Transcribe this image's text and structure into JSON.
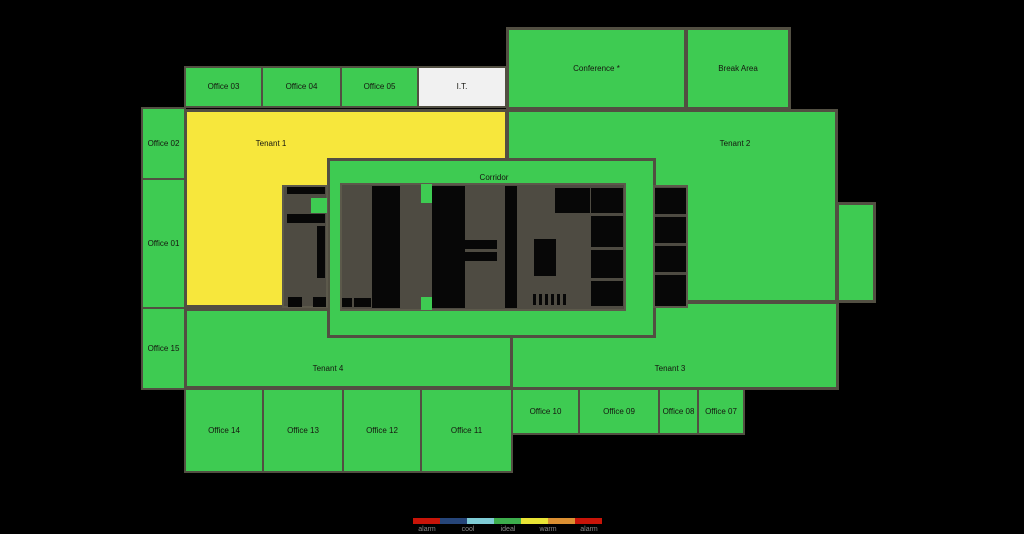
{
  "colors": {
    "background": "#000000",
    "ideal": "#3ecb52",
    "warm": "#f7e73c",
    "neutral": "#f1f1f1",
    "core_base": "#4e4b42",
    "core_black": "#070707",
    "room_border": "#524f42",
    "label_text": "#15150f",
    "legend_label_text": "#8a8a8a"
  },
  "floorplan": {
    "rooms": [
      {
        "id": "tenant-2",
        "label": "Tenant 2",
        "x": 506,
        "y": 109,
        "w": 332,
        "h": 194,
        "fill": "ideal",
        "bw": 3,
        "lab": [
          226,
          32
        ]
      },
      {
        "id": "tenant-2-east-wing",
        "label": "",
        "x": 836,
        "y": 202,
        "w": 40,
        "h": 101,
        "fill": "ideal",
        "bw": 3
      },
      {
        "id": "tenant-1",
        "label": "Tenant 1",
        "x": 184,
        "y": 109,
        "w": 324,
        "h": 199,
        "fill": "warm",
        "bw": 3,
        "lab": [
          84,
          32
        ]
      },
      {
        "id": "tenant-4",
        "label": "Tenant 4",
        "x": 184,
        "y": 308,
        "w": 329,
        "h": 81,
        "fill": "ideal",
        "bw": 3,
        "lab": [
          141,
          58
        ]
      },
      {
        "id": "tenant-3",
        "label": "Tenant 3",
        "x": 510,
        "y": 301,
        "w": 329,
        "h": 89,
        "fill": "ideal",
        "bw": 3,
        "lab": [
          157,
          65
        ]
      },
      {
        "id": "corridor",
        "label": "Corridor",
        "x": 327,
        "y": 158,
        "w": 329,
        "h": 180,
        "fill": "ideal",
        "bw": 3,
        "lab": [
          164,
          17
        ]
      },
      {
        "id": "office-03",
        "label": "Office 03",
        "x": 184,
        "y": 66,
        "w": 79,
        "h": 42,
        "fill": "ideal",
        "bw": 2
      },
      {
        "id": "office-04",
        "label": "Office 04",
        "x": 261,
        "y": 66,
        "w": 81,
        "h": 42,
        "fill": "ideal",
        "bw": 2
      },
      {
        "id": "office-05",
        "label": "Office 05",
        "x": 340,
        "y": 66,
        "w": 79,
        "h": 42,
        "fill": "ideal",
        "bw": 2
      },
      {
        "id": "it-room",
        "label": "I.T.",
        "x": 417,
        "y": 66,
        "w": 90,
        "h": 42,
        "fill": "neutral",
        "bw": 2
      },
      {
        "id": "conference",
        "label": "Conference *",
        "x": 506,
        "y": 27,
        "w": 181,
        "h": 83,
        "fill": "ideal",
        "bw": 3
      },
      {
        "id": "break-area",
        "label": "Break Area",
        "x": 685,
        "y": 27,
        "w": 106,
        "h": 83,
        "fill": "ideal",
        "bw": 3
      },
      {
        "id": "office-02",
        "label": "Office 02",
        "x": 141,
        "y": 107,
        "w": 45,
        "h": 73,
        "fill": "ideal",
        "bw": 2
      },
      {
        "id": "office-01",
        "label": "Office 01",
        "x": 141,
        "y": 178,
        "w": 45,
        "h": 131,
        "fill": "ideal",
        "bw": 2
      },
      {
        "id": "office-15",
        "label": "Office 15",
        "x": 141,
        "y": 307,
        "w": 45,
        "h": 83,
        "fill": "ideal",
        "bw": 2
      },
      {
        "id": "office-14",
        "label": "Office 14",
        "x": 184,
        "y": 388,
        "w": 80,
        "h": 85,
        "fill": "ideal",
        "bw": 2
      },
      {
        "id": "office-13",
        "label": "Office 13",
        "x": 262,
        "y": 388,
        "w": 82,
        "h": 85,
        "fill": "ideal",
        "bw": 2
      },
      {
        "id": "office-12",
        "label": "Office 12",
        "x": 342,
        "y": 388,
        "w": 80,
        "h": 85,
        "fill": "ideal",
        "bw": 2
      },
      {
        "id": "office-11",
        "label": "Office 11",
        "x": 420,
        "y": 388,
        "w": 93,
        "h": 85,
        "fill": "ideal",
        "bw": 2
      },
      {
        "id": "office-10",
        "label": "Office 10",
        "x": 511,
        "y": 388,
        "w": 69,
        "h": 47,
        "fill": "ideal",
        "bw": 2
      },
      {
        "id": "office-09",
        "label": "Office 09",
        "x": 578,
        "y": 388,
        "w": 82,
        "h": 47,
        "fill": "ideal",
        "bw": 2
      },
      {
        "id": "office-08",
        "label": "Office 08",
        "x": 658,
        "y": 388,
        "w": 41,
        "h": 47,
        "fill": "ideal",
        "bw": 2
      },
      {
        "id": "office-07",
        "label": "Office 07",
        "x": 697,
        "y": 388,
        "w": 48,
        "h": 47,
        "fill": "ideal",
        "bw": 2
      }
    ],
    "core": {
      "blocks": [
        {
          "x": 282,
          "y": 185,
          "w": 46,
          "h": 123
        },
        {
          "x": 653,
          "y": 185,
          "w": 35,
          "h": 123
        },
        {
          "x": 340,
          "y": 183,
          "w": 286,
          "h": 128
        }
      ],
      "cells": [
        {
          "x": 287,
          "y": 187,
          "w": 38,
          "h": 7,
          "f": "core_black"
        },
        {
          "x": 311,
          "y": 198,
          "w": 16,
          "h": 15,
          "f": "ideal"
        },
        {
          "x": 287,
          "y": 214,
          "w": 38,
          "h": 9,
          "f": "core_black"
        },
        {
          "x": 317,
          "y": 226,
          "w": 8,
          "h": 52,
          "f": "core_black"
        },
        {
          "x": 288,
          "y": 297,
          "w": 14,
          "h": 10,
          "f": "core_black"
        },
        {
          "x": 313,
          "y": 297,
          "w": 13,
          "h": 10,
          "f": "core_black"
        },
        {
          "x": 372,
          "y": 186,
          "w": 28,
          "h": 122,
          "f": "core_black"
        },
        {
          "x": 342,
          "y": 298,
          "w": 10,
          "h": 9,
          "f": "core_black"
        },
        {
          "x": 354,
          "y": 298,
          "w": 17,
          "h": 9,
          "f": "core_black"
        },
        {
          "x": 432,
          "y": 186,
          "w": 33,
          "h": 122,
          "f": "core_black"
        },
        {
          "x": 465,
          "y": 240,
          "w": 32,
          "h": 9,
          "f": "core_black"
        },
        {
          "x": 465,
          "y": 252,
          "w": 32,
          "h": 9,
          "f": "core_black"
        },
        {
          "x": 505,
          "y": 186,
          "w": 12,
          "h": 122,
          "f": "core_black"
        },
        {
          "x": 534,
          "y": 239,
          "w": 22,
          "h": 37,
          "f": "core_black"
        },
        {
          "x": 555,
          "y": 188,
          "w": 35,
          "h": 25,
          "f": "core_black"
        },
        {
          "x": 591,
          "y": 188,
          "w": 32,
          "h": 25,
          "f": "core_black"
        },
        {
          "x": 591,
          "y": 216,
          "w": 32,
          "h": 31,
          "f": "core_black"
        },
        {
          "x": 591,
          "y": 250,
          "w": 32,
          "h": 28,
          "f": "core_black"
        },
        {
          "x": 591,
          "y": 281,
          "w": 32,
          "h": 25,
          "f": "core_black"
        },
        {
          "x": 533,
          "y": 294,
          "w": 3,
          "h": 11,
          "f": "core_black"
        },
        {
          "x": 539,
          "y": 294,
          "w": 3,
          "h": 11,
          "f": "core_black"
        },
        {
          "x": 545,
          "y": 294,
          "w": 3,
          "h": 11,
          "f": "core_black"
        },
        {
          "x": 551,
          "y": 294,
          "w": 3,
          "h": 11,
          "f": "core_black"
        },
        {
          "x": 557,
          "y": 294,
          "w": 3,
          "h": 11,
          "f": "core_black"
        },
        {
          "x": 563,
          "y": 294,
          "w": 3,
          "h": 11,
          "f": "core_black"
        },
        {
          "x": 655,
          "y": 188,
          "w": 31,
          "h": 26,
          "f": "core_black"
        },
        {
          "x": 655,
          "y": 217,
          "w": 31,
          "h": 26,
          "f": "core_black"
        },
        {
          "x": 655,
          "y": 246,
          "w": 31,
          "h": 26,
          "f": "core_black"
        },
        {
          "x": 655,
          "y": 275,
          "w": 31,
          "h": 31,
          "f": "core_black"
        },
        {
          "x": 421,
          "y": 184,
          "w": 11,
          "h": 19,
          "f": "ideal"
        },
        {
          "x": 421,
          "y": 297,
          "w": 11,
          "h": 13,
          "f": "ideal"
        }
      ]
    }
  },
  "legend": {
    "bar": {
      "x": 413,
      "y": 518,
      "segment_width": 27,
      "height": 6
    },
    "segments": [
      {
        "name": "alarm-cold",
        "color": "#c81408"
      },
      {
        "name": "cool-deep",
        "color": "#264579"
      },
      {
        "name": "cool-light",
        "color": "#7fccd6"
      },
      {
        "name": "ideal",
        "color": "#3dad4d"
      },
      {
        "name": "warm",
        "color": "#e9e435"
      },
      {
        "name": "warm-hot",
        "color": "#dc9032"
      },
      {
        "name": "alarm-hot",
        "color": "#c81408"
      }
    ],
    "labels_y": 526,
    "labels": [
      {
        "text": "alarm",
        "x": 427
      },
      {
        "text": "cool",
        "x": 468
      },
      {
        "text": "ideal",
        "x": 508
      },
      {
        "text": "warm",
        "x": 548
      },
      {
        "text": "alarm",
        "x": 589
      }
    ]
  }
}
